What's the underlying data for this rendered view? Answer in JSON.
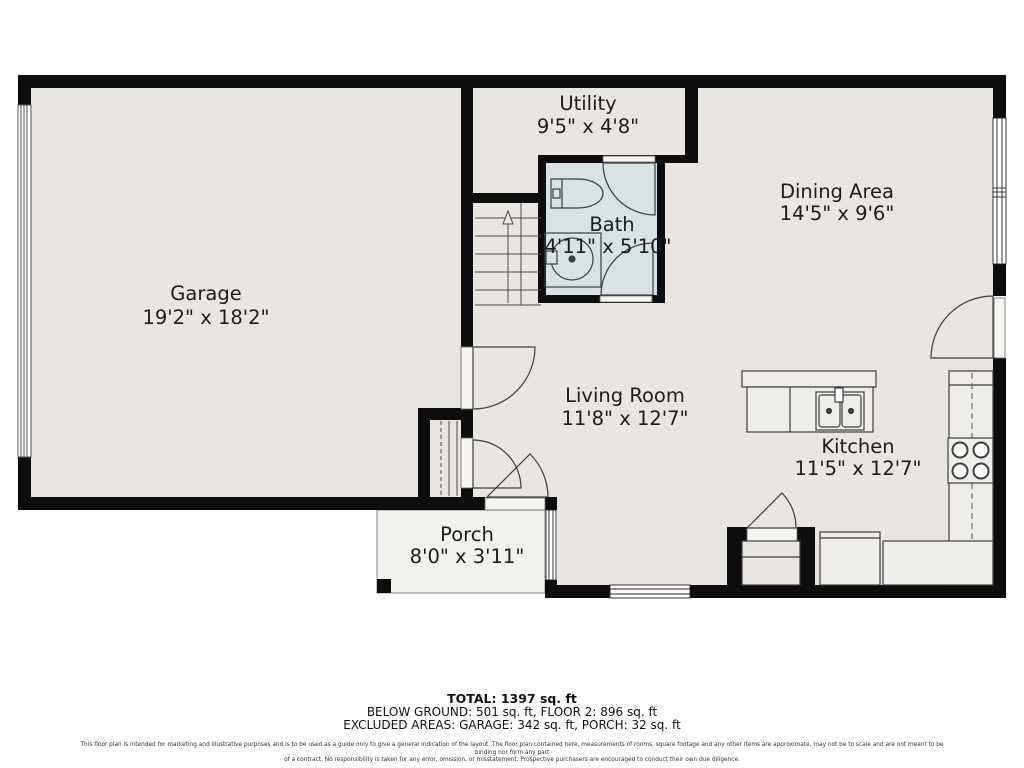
{
  "rooms": [
    {
      "name": "Garage",
      "dims": "19'2\" x 18'2\""
    },
    {
      "name": "Utility",
      "dims": "9'5\" x 4'8\""
    },
    {
      "name": "Bath",
      "dims": "4'11\" x 5'10\""
    },
    {
      "name": "Dining Area",
      "dims": "14'5\" x 9'6\""
    },
    {
      "name": "Living Room",
      "dims": "11'8\" x 12'7\""
    },
    {
      "name": "Kitchen",
      "dims": "11'5\" x 12'7\""
    },
    {
      "name": "Porch",
      "dims": "8'0\" x 3'11\""
    }
  ],
  "summary": {
    "total": "TOTAL: 1397 sq. ft",
    "breakdown": "BELOW GROUND: 501 sq. ft, FLOOR 2: 896 sq. ft",
    "excluded": "EXCLUDED AREAS: GARAGE: 342 sq. ft, PORCH: 32 sq. ft"
  },
  "disclaimer": {
    "line1": "This floor plan is intended for marketing and illustrative purposes and is to be used as a guide only to give a general indication of the layout. The floor plan contained here, measurements of rooms, square footage and any other items are approximate, may not be to scale and are not meant to be binding nor form any part",
    "line2": "of a contract. No responsibility is taken for any error, omission, or misstatement. Prospective purchasers are encouraged to conduct their own due diligence."
  },
  "colors": {
    "wall": "#0d0d0d",
    "floor": "#e9e5e0",
    "bath_floor": "#d6e4e6",
    "porch_floor": "#f2f1ee",
    "counter": "#efede9",
    "fixture_line": "#3d3d3d"
  }
}
